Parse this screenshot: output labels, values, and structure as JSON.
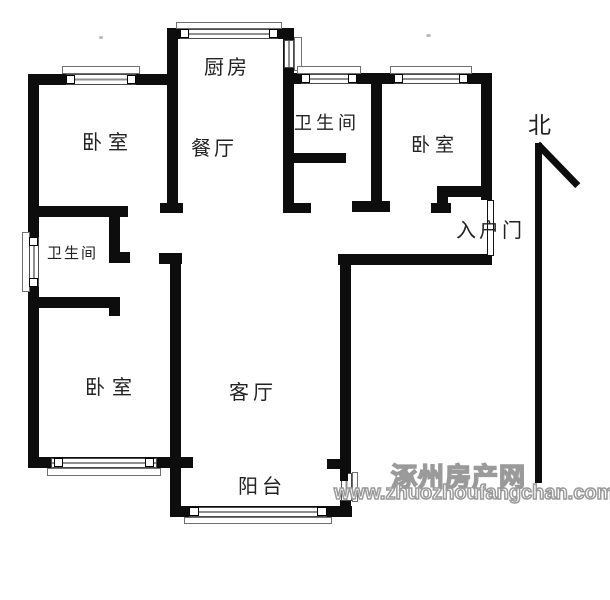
{
  "rooms": {
    "kitchen": "厨房",
    "dining": "餐厅",
    "bathroom_upper": "卫生间",
    "bedroom_top_left": "卧室",
    "bedroom_top_right": "卧室",
    "bedroom_bottom_left": "卧室",
    "bathroom_lower": "卫生间",
    "living_room": "客厅",
    "balcony": "阳台",
    "entry_door": "入户门"
  },
  "compass": {
    "north_label": "北"
  },
  "watermark": {
    "site_name": "涿州房产网",
    "site_url": "www.zhuozhoufangchan.com",
    "color": "#9a9a9a"
  },
  "colors": {
    "wall": "#0d0d0d",
    "background": "#ffffff"
  }
}
